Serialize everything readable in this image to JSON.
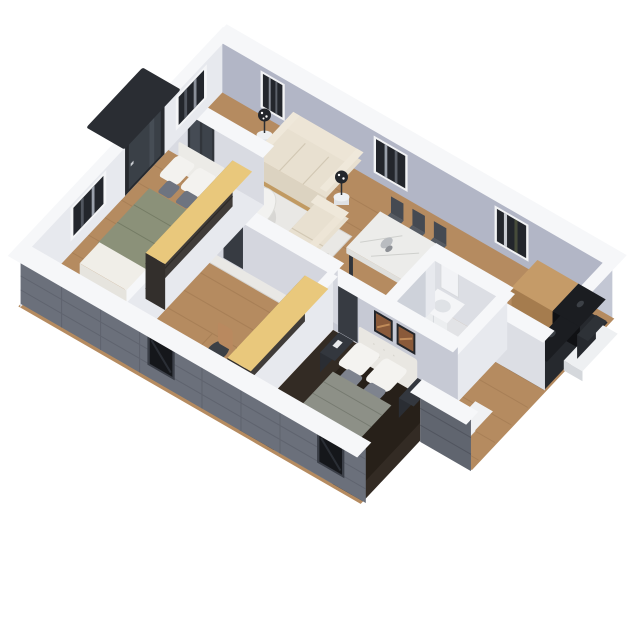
{
  "scene": {
    "type": "isometric-3d-floor-plan-render",
    "background": "#ffffff",
    "rooms": [
      {
        "name": "entry",
        "furniture": [
          "entry-door",
          "porch-canopy"
        ]
      },
      {
        "name": "living-room",
        "furniture": [
          "three-seat-sofa",
          "two-seat-sofa",
          "round-coffee-table",
          "area-rug",
          "side-table-lamp",
          "side-table-lamp"
        ]
      },
      {
        "name": "dining-area",
        "furniture": [
          "marble-dining-table",
          "six-dining-chairs"
        ]
      },
      {
        "name": "kitchen",
        "furniture": [
          "wood-counter",
          "black-counter"
        ]
      },
      {
        "name": "bedroom-1",
        "furniture": [
          "bed-sage-blanket",
          "wardrobe-open-shelves"
        ]
      },
      {
        "name": "home-office",
        "furniture": [
          "desk",
          "office-chair",
          "wardrobe-open-shelves"
        ]
      },
      {
        "name": "master-bedroom",
        "furniture": [
          "double-bed",
          "two-nightstands",
          "two-wall-art-frames"
        ]
      },
      {
        "name": "bathroom",
        "furniture": [
          "vanity-cabinet",
          "toilet",
          "mirror-cabinet"
        ]
      },
      {
        "name": "utility-room",
        "furniture": [
          "washer",
          "wall-panel"
        ]
      }
    ],
    "windows": {
      "back_wall": 3,
      "end_wall": 2,
      "front_wall": 2
    }
  },
  "colors": {
    "wall_back": "#b2b6c6",
    "wall_end": "#c3c7d4",
    "wall_light": "#dcdee4",
    "wall_lighter": "#e7e9ee",
    "cap_white": "#f6f7f9",
    "exterior_dark": "#6b707b",
    "floor_wood": "#b58b60",
    "floor_master": "#332b24",
    "rug_master": "#272019",
    "tile": "#e2e3e6",
    "rug": "#e9e8e5",
    "sofa": "#e8e0d0",
    "sofa_front": "#dcd3c1",
    "wood_accent": "#c19a62",
    "wardrobe_top": "#e9c87c",
    "wardrobe_front": "#403c39",
    "sage": "#8b9179",
    "chair_dark": "#383c43",
    "table_white": "#ececea",
    "counter_wood": "#c59b68",
    "counter_black": "#1b1d21",
    "bed_white": "#f1f0ec",
    "blanket_gray": "#8d9087",
    "nightstand": "#33373e",
    "art_brown": "#8a5a3a",
    "door_dark": "#373b42",
    "glass_dark": "#23262c",
    "plant": "#5e7d4a",
    "headboard": "#e9e7e2",
    "platform": "#eef0f2",
    "porch_cap": "#2a2d33",
    "window_glass_ext": "#15171b"
  }
}
